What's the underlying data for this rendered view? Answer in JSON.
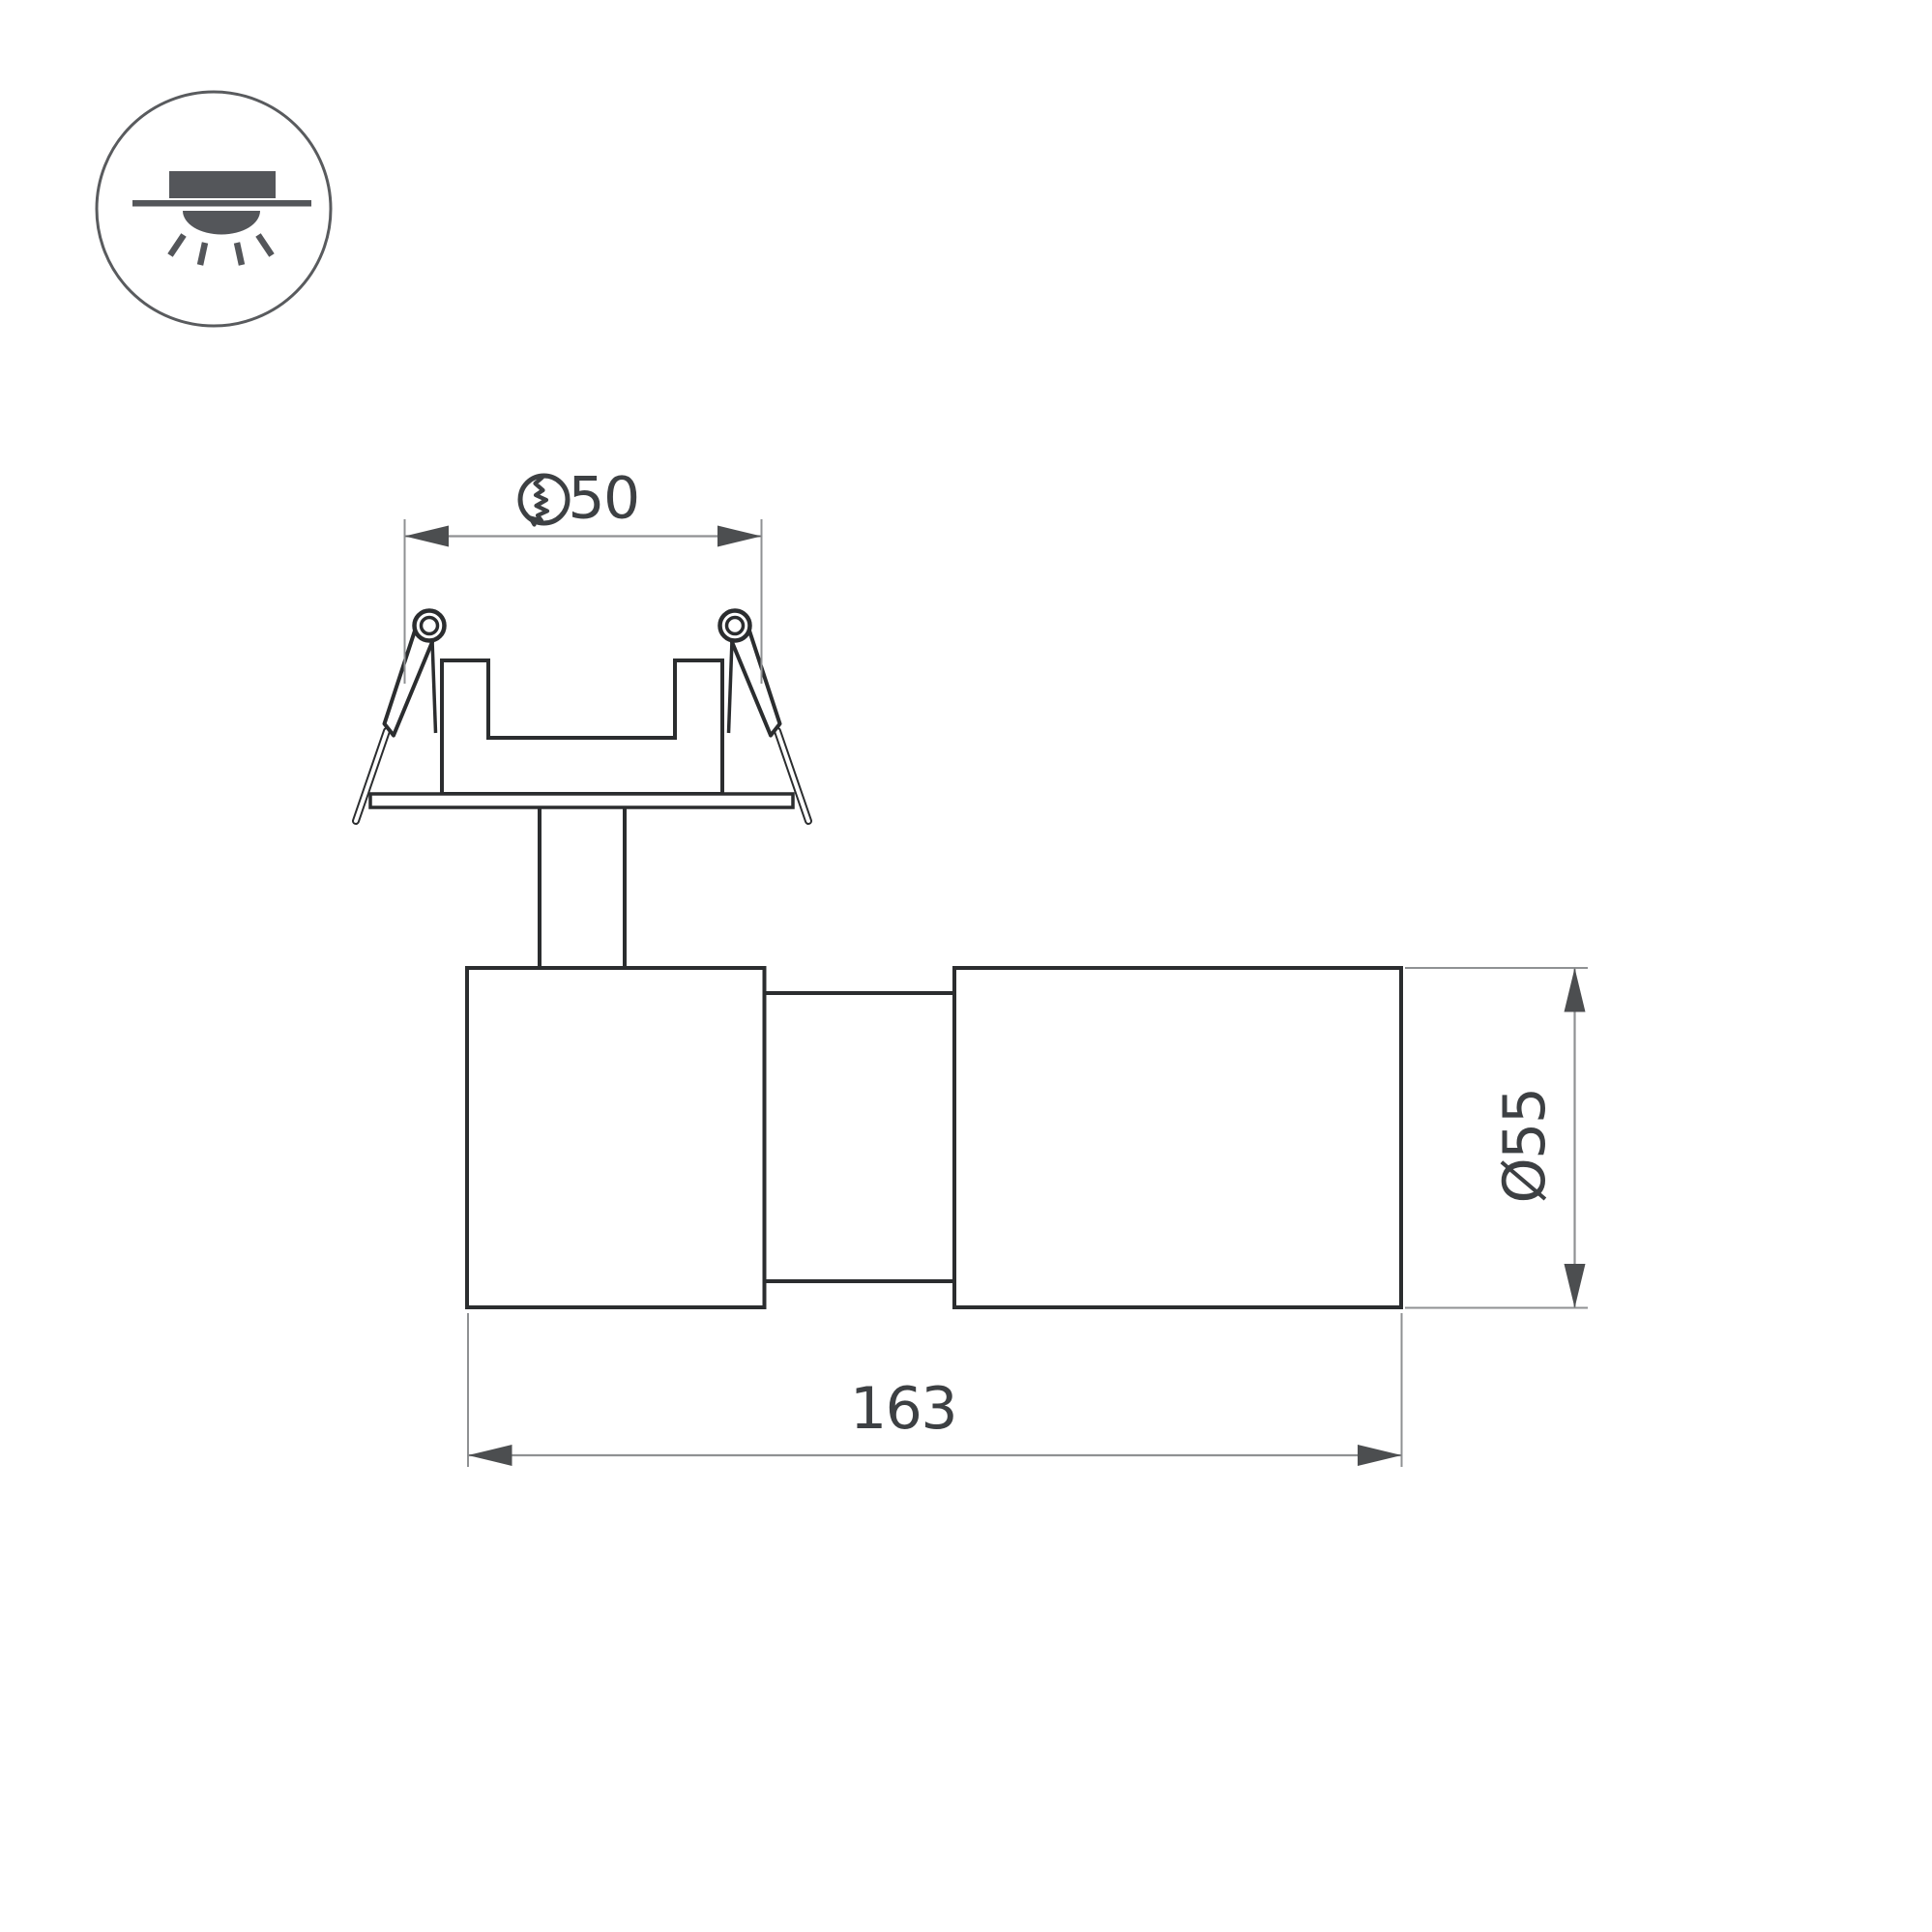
{
  "legend": {
    "icon": "recessed-downlight-icon"
  },
  "dimensions": {
    "cutout": {
      "value": "50",
      "symbol": "hole-cutout-icon"
    },
    "length": {
      "value": "163"
    },
    "diameter": {
      "value": "Ø55"
    }
  },
  "colors": {
    "background": "#ffffff",
    "object_line": "#2b2d2f",
    "dimension_line": "#8f9193",
    "arrow": "#4c4e50",
    "text": "#3d4043",
    "icon_fill": "#54565a",
    "icon_ring": "#595b5e"
  }
}
